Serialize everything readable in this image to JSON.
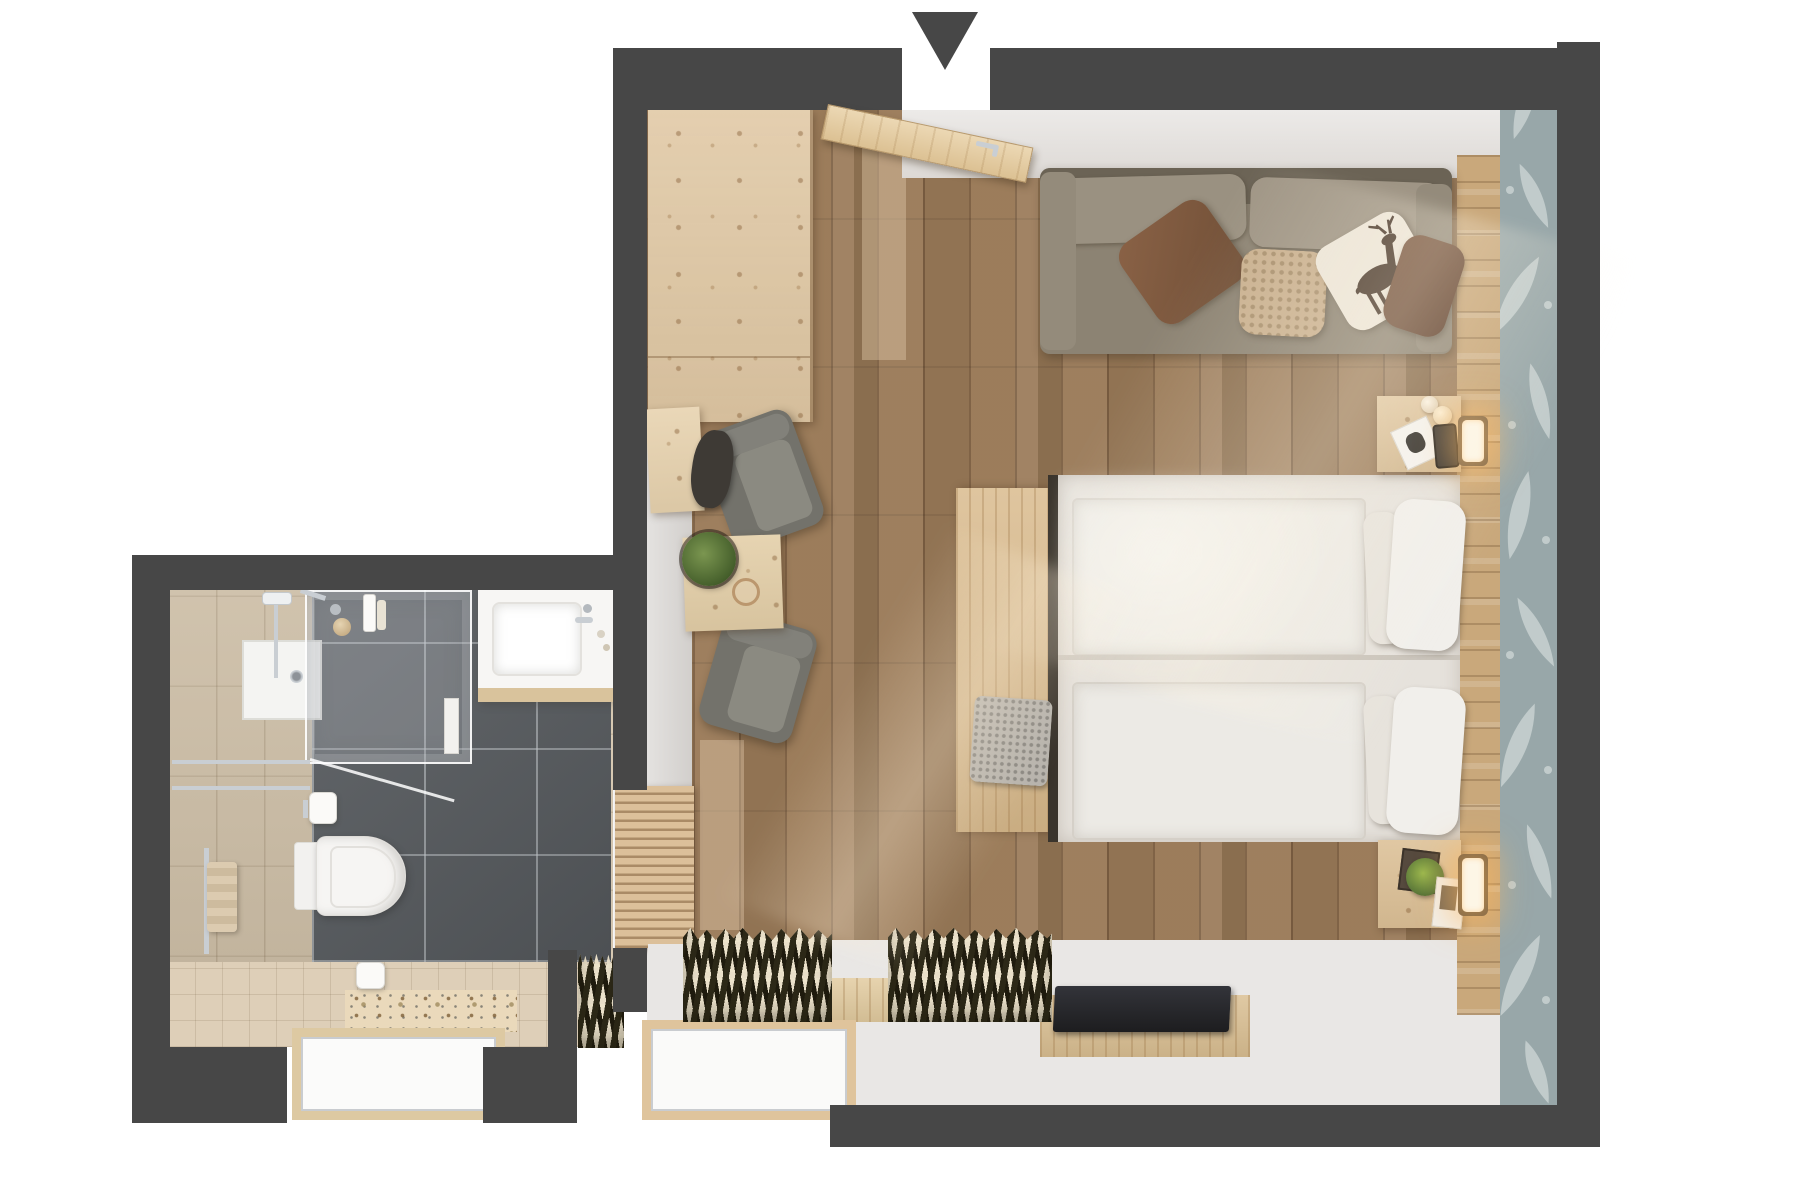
{
  "scene": {
    "kind": "3d-floor-plan-top-view",
    "description": "Top-down 3D render of a hotel guest room with bedroom and en-suite bathroom",
    "entrance_marker": "down-arrow at entry door, top center"
  },
  "palette": {
    "wall": "#474747",
    "exterior": "#ffffff",
    "floor_wood": "#9a7a58",
    "white_floor": "#e9e7e5",
    "pine": "#e0c8a4",
    "oak_panel": "#c9a87b",
    "bench_oak": "#d9ba8c",
    "bedding": "#e6e2dc",
    "duvet": "#eceae5",
    "pillow_white": "#f1efeb",
    "sofa": "#8c8373",
    "sofa_back": "#6b6355",
    "pillow_brown": "#7c5a40",
    "pillow_knit": "#c9b08f",
    "pillow_deer_bg": "#ece5d8",
    "deer": "#4a392c",
    "wallpaper": "#98a7a9",
    "wallpaper_motif": "#cdd6d5",
    "slate": "#595d61",
    "tile_beige": "#d7c9b3",
    "mosaic_beige": "#decfb8",
    "terrazzo": "#ead9bb",
    "chrome": "#c9ced3",
    "curtain_dark": "#2c2817",
    "curtain_light": "#e9dfc9",
    "plant": "#5d7a3a",
    "chair": "#73726b",
    "tv": "#1d1d1f",
    "glow": "#ffb85c"
  },
  "rooms": {
    "bedroom": {
      "label": "bedroom",
      "furniture": [
        "entrance-door",
        "wardrobe",
        "wall-desk",
        "backpack",
        "armchair-1",
        "armchair-2",
        "coffee-table",
        "potted-plant",
        "cup",
        "sofa",
        "brown-pillow",
        "knit-pillow",
        "deer-print-pillow",
        "double-bed",
        "duvet-left",
        "duvet-right",
        "pillows",
        "foot-bench",
        "knit-throw",
        "nightstand-top",
        "nightstand-bottom",
        "table-lamp",
        "wall-sconce-top",
        "wall-sconce-bottom",
        "book",
        "phone",
        "picture-frame",
        "succulent",
        "tv-panel",
        "tv-board",
        "curtain-left",
        "curtain-right",
        "curtain-small",
        "window-bay",
        "headboard-panel",
        "wallpaper-accent"
      ]
    },
    "bathroom": {
      "label": "bathroom",
      "furniture": [
        "shower-enclosure",
        "shower-tray",
        "shower-column",
        "washbasin-counter",
        "basin",
        "faucet",
        "wall-hung-toilet",
        "toilet-paper-roll",
        "spare-paper-roll",
        "towel-rail",
        "towel",
        "glass-door",
        "toiletry-bottles",
        "decor-ball",
        "terrazzo-sill",
        "bathroom-window-bay"
      ]
    }
  }
}
